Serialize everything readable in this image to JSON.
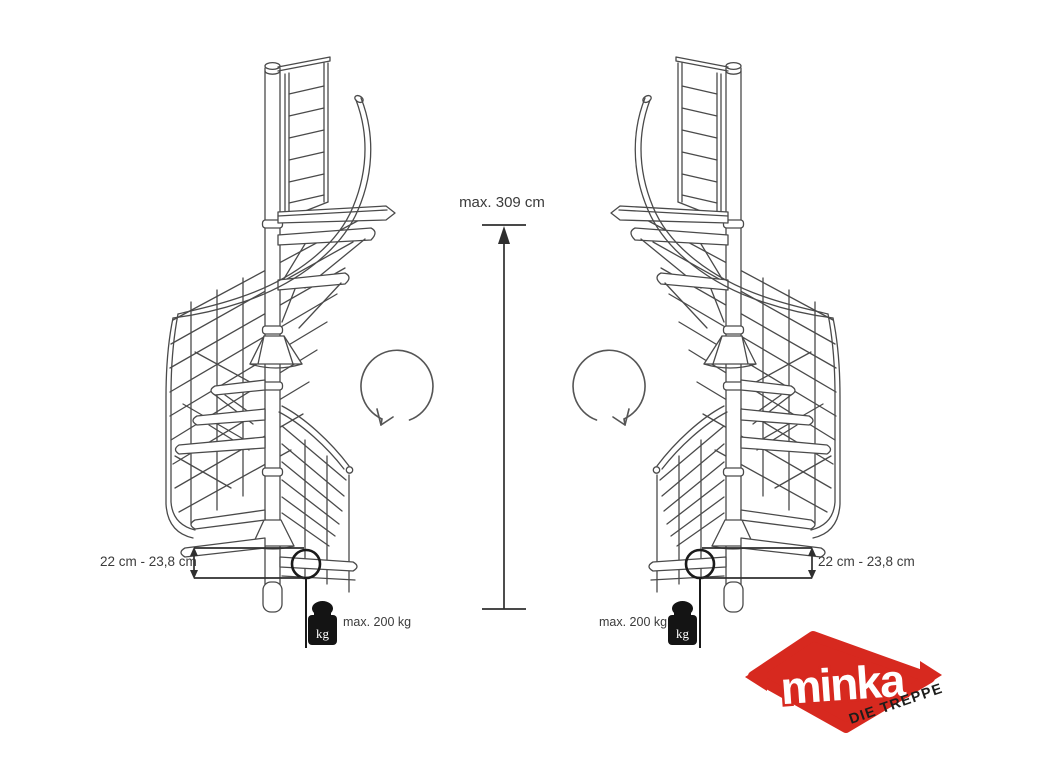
{
  "diagram": {
    "height_label": "max. 309 cm",
    "step_height_label_left": "22 cm - 23,8 cm",
    "step_height_label_right": "22 cm - 23,8 cm",
    "load_label_left": "max. 200 kg",
    "load_label_right": "max. 200 kg",
    "weight_unit": "kg"
  },
  "logo": {
    "brand": "minka",
    "tagline": "DIE TREPPE",
    "red": "#d7291f",
    "tagline_color": "#1d1d1b"
  },
  "colors": {
    "background": "#ffffff",
    "line": "#4a4a4a",
    "annotation": "#2f2f2f",
    "weight_black": "#141414"
  }
}
